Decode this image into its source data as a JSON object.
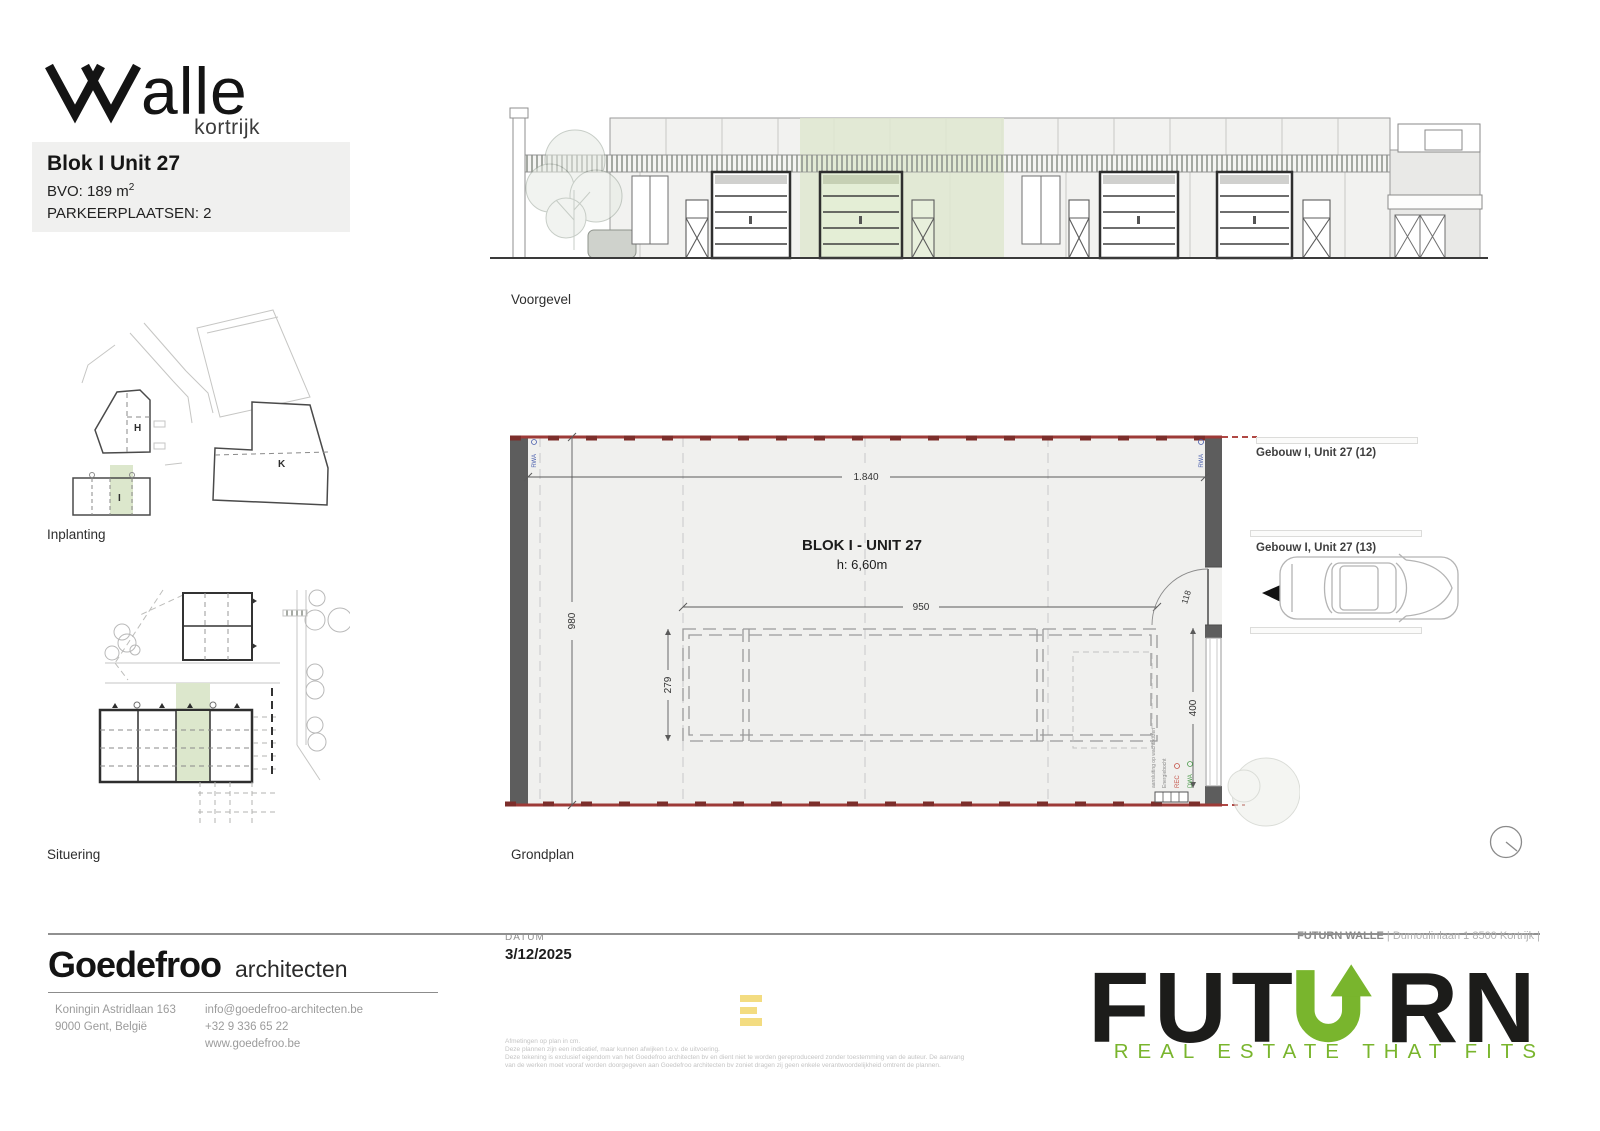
{
  "brand": {
    "logo_text": "walle",
    "logo_tail": "alle",
    "logo_sub": "kortrijk"
  },
  "unit_info": {
    "title": "Blok I Unit 27",
    "bvo_label": "BVO: 189 m",
    "bvo_sup": "2",
    "parking": "PARKEERPLAATSEN: 2"
  },
  "labels": {
    "voorgevel": "Voorgevel",
    "inplanting": "Inplanting",
    "situering": "Situering",
    "grondplan": "Grondplan"
  },
  "siteplan": {
    "building_h": "H",
    "building_i": "I",
    "building_k": "K"
  },
  "floorplan": {
    "title": "BLOK I - UNIT 27",
    "height": "h: 6,60m",
    "dims": {
      "total_width": "1.840",
      "total_depth": "980",
      "mezz_width": "950",
      "mezz_depth": "279",
      "door": "118",
      "gate": "400"
    },
    "annotations": {
      "rwa_left": "RWA",
      "rwa_right": "RWA",
      "rec": "REC",
      "dwa": "DWA",
      "note1": "aansluiting op wachtbuizen",
      "note2": "Energiebocht"
    }
  },
  "neighbors": {
    "unit12": "Gebouw I, Unit 27 (12)",
    "unit13": "Gebouw I, Unit 27 (13)"
  },
  "architect": {
    "name": "Goedefroo",
    "suffix": "architecten",
    "address1": "Koningin Astridlaan 163",
    "address2": "9000 Gent, België",
    "email": "info@goedefroo-architecten.be",
    "phone": "+32 9 336 65 22",
    "website": "www.goedefroo.be"
  },
  "footer": {
    "datum_label": "DATUM",
    "datum_value": "3/12/2025",
    "ref_bold": "FUTURN WALLE",
    "ref_rest": "| Dumoulinlaan 1 8500 Kortrijk |",
    "disclaimer": [
      "Afmetingen op plan in cm.",
      "Deze plannen zijn een indicatief, maar kunnen afwijken t.o.v. de uitvoering.",
      "Deze tekening is exclusief eigendom van het Goedefroo architecten bv en dient niet te worden gereproduceerd zonder toestemming van de auteur. De aanvang",
      "van de werken moet vooraf worden doorgegeven aan Goedefroo architecten bv zoniet dragen zij geen enkele verantwoordelijkheid omtrent de plannen."
    ]
  },
  "futurn": {
    "logo_left": "FUT",
    "logo_right": "RN",
    "tagline": "REAL ESTATE THAT FITS"
  },
  "colors": {
    "accent_green": "#79b52d",
    "highlight_green": "#dfe8d0",
    "plan_red": "#9d3a37",
    "wall_gray": "#5d5d5d",
    "mark_yellow": "#f3dc81",
    "rwa_blue": "#4a5fae"
  }
}
